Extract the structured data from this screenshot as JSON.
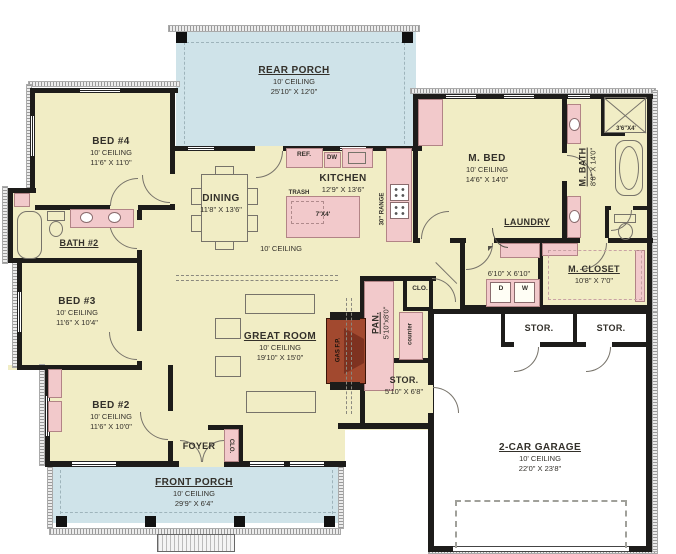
{
  "palette": {
    "floor": "#f1edc5",
    "porch": "#cfe3e9",
    "fixture_pink": "#f2c9cb",
    "fireplace_red": "#a2492f",
    "wall_black": "#1d1c1a"
  },
  "rooms": {
    "rear_porch": {
      "name": "REAR PORCH",
      "ceiling": "10' CEILING",
      "dims": "25'10\" X 12'0\""
    },
    "bed4": {
      "name": "BED #4",
      "ceiling": "10' CEILING",
      "dims": "11'6\" X 11'0\""
    },
    "bath2": {
      "name": "BATH #2"
    },
    "bed3": {
      "name": "BED #3",
      "ceiling": "10' CEILING",
      "dims": "11'6\" X 10'4\""
    },
    "bed2": {
      "name": "BED #2",
      "ceiling": "10' CEILING",
      "dims": "11'6\" X 10'0\""
    },
    "dining": {
      "name": "DINING",
      "dims": "11'8\" X 13'6\""
    },
    "kitchen": {
      "name": "KITCHEN",
      "dims": "12'9\" X 13'6\""
    },
    "open_area": {
      "ceiling": "10' CEILING"
    },
    "great_room": {
      "name": "GREAT ROOM",
      "ceiling": "10' CEILING",
      "dims": "19'10\" X 15'0\""
    },
    "m_bed": {
      "name": "M. BED",
      "ceiling": "10' CEILING",
      "dims": "14'6\" X 14'0\""
    },
    "m_bath": {
      "name": "M. BATH",
      "dims": "8'8\" X 14'0\""
    },
    "laundry": {
      "name": "LAUNDRY",
      "dims": "6'10\" X 6'10\""
    },
    "m_closet": {
      "name": "M. CLOSET",
      "dims": "10'8\" X 7'0\""
    },
    "pantry": {
      "name": "PAN.",
      "dims": "5'10\"x8'0\"",
      "counter": "counter"
    },
    "closet_hall": {
      "name": "CLO."
    },
    "closet_foyer": {
      "name": "CLO."
    },
    "stor_center": {
      "name": "STOR.",
      "dims": "5'10\" X 6'8\""
    },
    "stor_left": {
      "name": "STOR."
    },
    "stor_right": {
      "name": "STOR."
    },
    "garage": {
      "name": "2-CAR GARAGE",
      "ceiling": "10' CEILING",
      "dims": "22'0\" X 23'8\""
    },
    "foyer": {
      "name": "FOYER"
    },
    "front_porch": {
      "name": "FRONT PORCH",
      "ceiling": "10' CEILING",
      "dims": "29'9\" X 6'4\""
    }
  },
  "fixtures": {
    "ref": "REF.",
    "dw": "DW",
    "trash": "TRASH",
    "island": "7'X4'",
    "range": "30\" RANGE",
    "fireplace": "GAS F.P.",
    "dryer": "D",
    "washer": "W",
    "shower": "3'6\"X4'"
  }
}
